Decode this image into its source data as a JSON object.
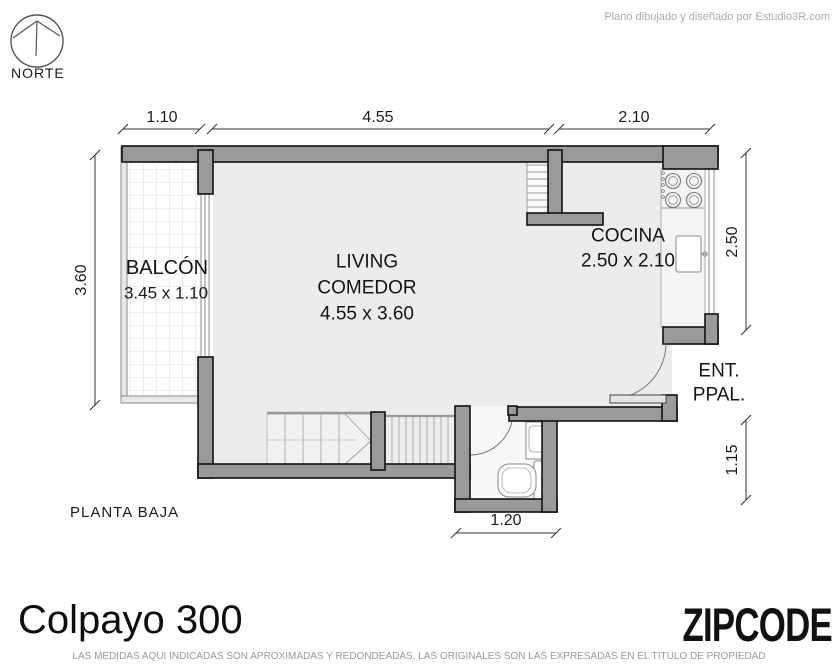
{
  "meta": {
    "credit": "Plano dibujado y diseñado por Estudio3R.com"
  },
  "north": {
    "label": "NORTE"
  },
  "rooms": {
    "balcony": {
      "name": "BALCÓN",
      "dims": "3.45 x 1.10"
    },
    "living": {
      "name_line1": "LIVING",
      "name_line2": "COMEDOR",
      "dims": "4.55 x 3.60"
    },
    "kitchen": {
      "name": "COCINA",
      "dims": "2.50 x 2.10"
    },
    "entrance": {
      "line1": "ENT.",
      "line2": "PPAL."
    }
  },
  "dimensions": {
    "top_left": "1.10",
    "top_mid": "4.55",
    "top_right": "2.10",
    "left": "3.60",
    "right_upper": "2.50",
    "right_lower": "1.15",
    "bottom": "1.20"
  },
  "floor_label": "PLANTA BAJA",
  "title": "Colpayo 300",
  "brand": "ZIPCODE",
  "disclaimer": "LAS MEDIDAS AQUI INDICADAS SON APROXIMADAS Y REDONDEADAS, LAS ORIGINALES SON LAS EXPRESADAS EN EL TITULO DE PROPIEDAD",
  "colors": {
    "wall": "#9a9a9a",
    "floor": "#ececec",
    "outline": "#111111"
  }
}
